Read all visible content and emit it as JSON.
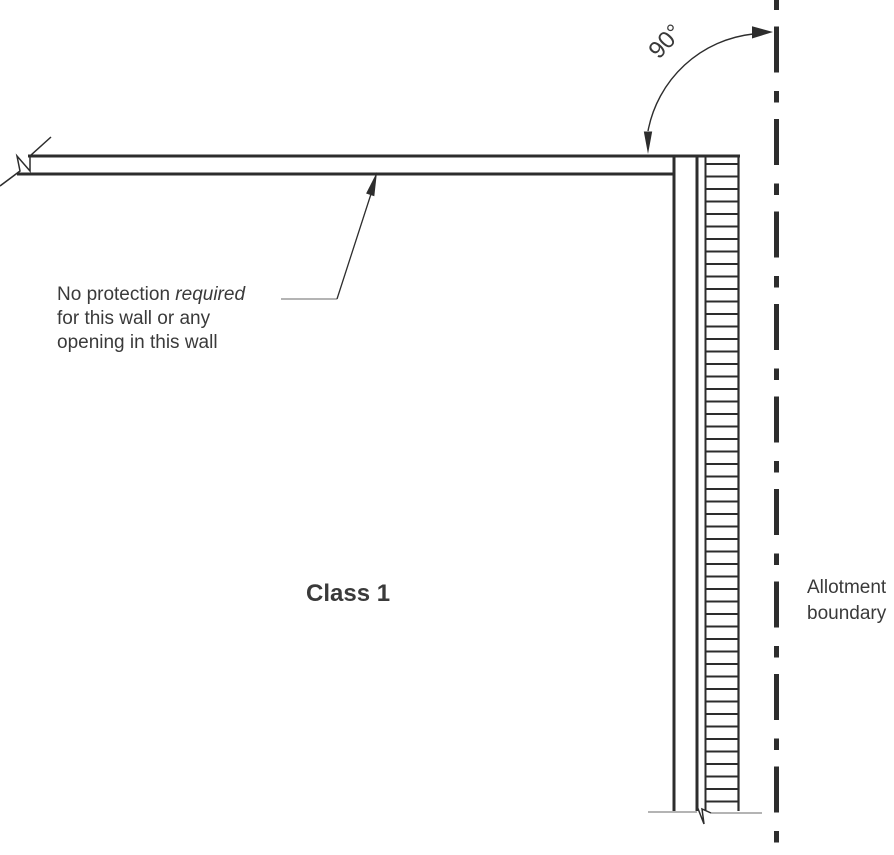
{
  "diagram": {
    "title": "Allotment boundary wall protection diagram",
    "note": {
      "line1_regular": "No protection ",
      "line1_italic": "required",
      "line2": "for this wall or any",
      "line3": "opening in this wall"
    },
    "class_label": "Class 1",
    "angle_label": "90°",
    "boundary_label": {
      "line1": "Allotment",
      "line2": "boundary"
    },
    "colors": {
      "line": "#2d2d2d",
      "text": "#3a3a3a",
      "muted": "#9c9c9c",
      "background": "#ffffff"
    }
  }
}
